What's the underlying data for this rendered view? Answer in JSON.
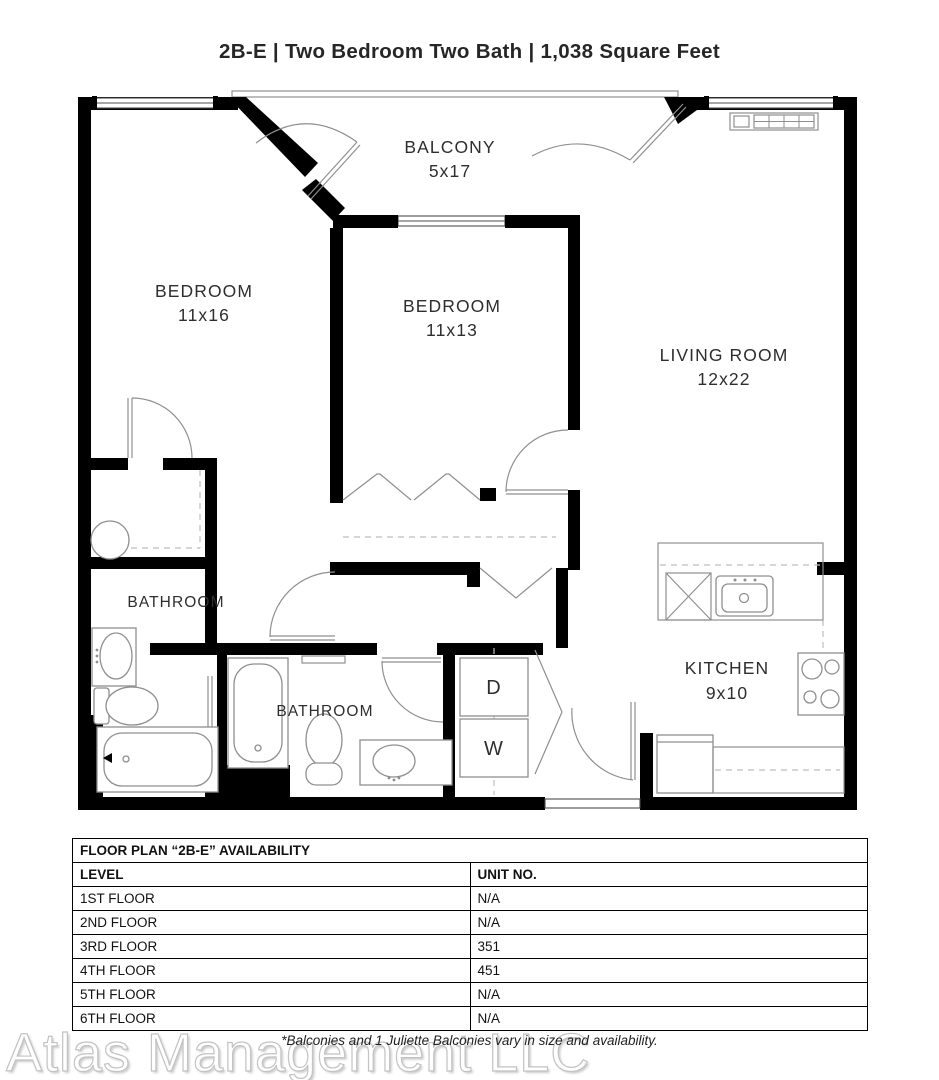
{
  "title": "2B-E | Two Bedroom Two Bath | 1,038 Square Feet",
  "plan": {
    "rooms": {
      "balcony": {
        "name": "BALCONY",
        "dims": "5x17"
      },
      "bedroom_left": {
        "name": "BEDROOM",
        "dims": "11x16"
      },
      "bedroom_middle": {
        "name": "BEDROOM",
        "dims": "11x13"
      },
      "living_room": {
        "name": "LIVING ROOM",
        "dims": "12x22"
      },
      "bathroom_left": {
        "name": "BATHROOM"
      },
      "bathroom_center": {
        "name": "BATHROOM"
      },
      "kitchen": {
        "name": "KITCHEN",
        "dims": "9x10"
      },
      "dryer": "D",
      "washer": "W"
    },
    "fixtures": [
      "bathtub",
      "toilet",
      "sink",
      "kitchen-sink",
      "stove-burners",
      "refrigerator",
      "dishwasher",
      "washer-dryer-stack",
      "bifold-closet-doors",
      "door-swings",
      "windows",
      "balcony-railing",
      "wall-heater",
      "water-heater"
    ],
    "colors": {
      "walls": "#000000",
      "thin_lines": "#8f8f8f",
      "dashed": "#bdbdbd"
    }
  },
  "availability": {
    "title": "FLOOR PLAN “2B-E” AVAILABILITY",
    "columns": {
      "level": "LEVEL",
      "unit": "UNIT NO."
    },
    "rows": [
      {
        "level": "1ST FLOOR",
        "unit": "N/A"
      },
      {
        "level": "2ND FLOOR",
        "unit": "N/A"
      },
      {
        "level": "3RD FLOOR",
        "unit": "351"
      },
      {
        "level": "4TH FLOOR",
        "unit": "451"
      },
      {
        "level": "5TH FLOOR",
        "unit": "N/A"
      },
      {
        "level": "6TH FLOOR",
        "unit": "N/A"
      }
    ]
  },
  "footnote": "*Balconies and 1 Juliette Balconies vary in size and availability.",
  "watermark": "Atlas Management LLC"
}
